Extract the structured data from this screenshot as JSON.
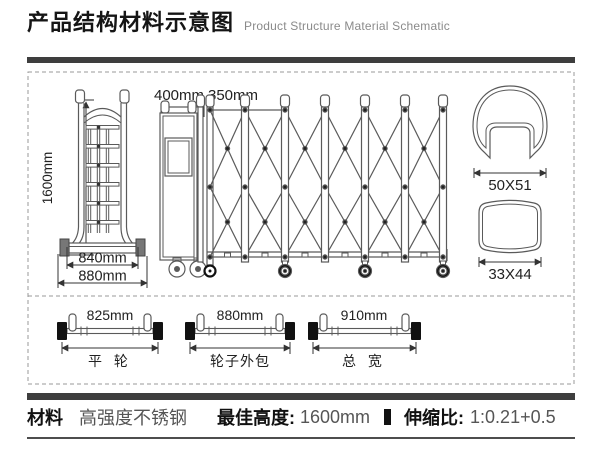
{
  "header": {
    "title": "产品结构材料示意图",
    "subtitle": "Product Structure Material Schematic"
  },
  "diagram": {
    "front_view": {
      "height_label": "1600mm",
      "inner_width_label": "840mm",
      "outer_width_label": "880mm"
    },
    "side_view": {
      "head_width_label": "400mm",
      "section_width_label": "350mm"
    },
    "profiles": [
      {
        "label": "50X51"
      },
      {
        "label": "33X44"
      }
    ],
    "axles": [
      {
        "length_label": "825mm",
        "name": "平 轮"
      },
      {
        "length_label": "880mm",
        "name": "轮子外包"
      },
      {
        "length_label": "910mm",
        "name": "总 宽"
      }
    ]
  },
  "footer": {
    "material_label": "材料",
    "material_value": "高强度不锈钢",
    "height_label": "最佳高度:",
    "height_value": "1600mm",
    "ratio_label": "伸缩比:",
    "ratio_value": "1:0.21+0.5"
  },
  "colors": {
    "accent_bar": "#3e3e3e",
    "line": "#5a5a5a"
  }
}
